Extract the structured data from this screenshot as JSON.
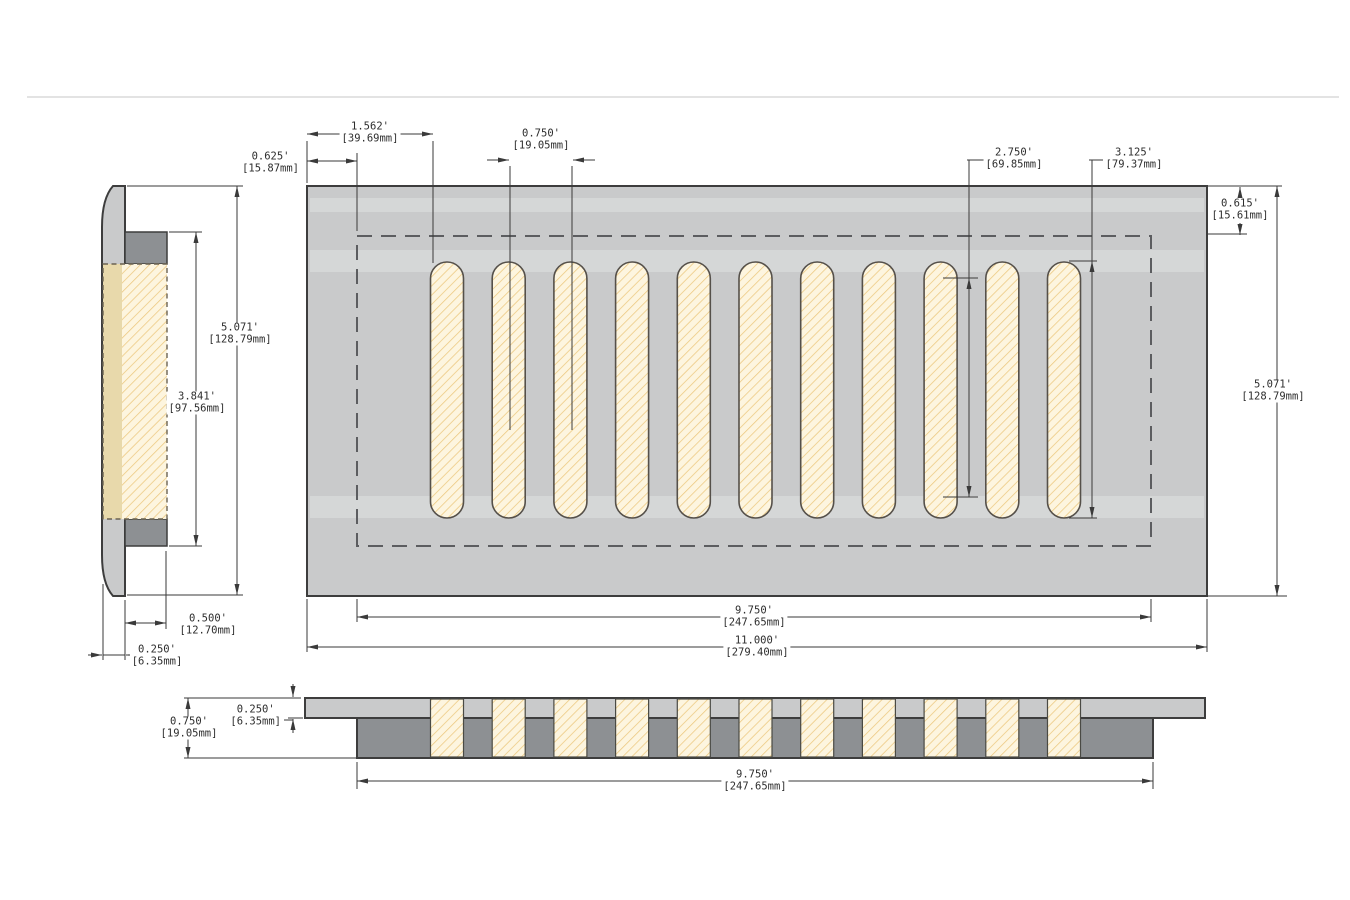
{
  "colors": {
    "plate": "#c9cacb",
    "collar": "#8d9093",
    "slot_fill": "#fdf5df",
    "hatch": "#ecc87e",
    "object_line": "#3d3d3d",
    "dim_line": "#3a3a3a",
    "dashed_line": "#5c5d60",
    "duct_strip": "#e8d9ab",
    "duct_dash": "#6b6352",
    "page_line": "#dadada",
    "text": "#2d2d2d"
  },
  "top_view": {
    "slot_count": 11,
    "dims": {
      "left_offset": {
        "in": "0.625'",
        "mm": "[15.87mm]"
      },
      "first_slot": {
        "in": "1.562'",
        "mm": "[39.69mm]"
      },
      "slot_pitch": {
        "in": "0.750'",
        "mm": "[19.05mm]"
      },
      "slot_inner_length": {
        "in": "2.750'",
        "mm": "[69.85mm]"
      },
      "slot_length": {
        "in": "3.125'",
        "mm": "[79.37mm]"
      },
      "top_offset": {
        "in": "0.615'",
        "mm": "[15.61mm]"
      },
      "height": {
        "in": "5.071'",
        "mm": "[128.79mm]"
      },
      "opening_width": {
        "in": "9.750'",
        "mm": "[247.65mm]"
      },
      "overall_width": {
        "in": "11.000'",
        "mm": "[279.40mm]"
      }
    }
  },
  "side_view": {
    "dims": {
      "height": {
        "in": "5.071'",
        "mm": "[128.79mm]"
      },
      "opening_height": {
        "in": "3.841'",
        "mm": "[97.56mm]"
      },
      "collar_depth": {
        "in": "0.500'",
        "mm": "[12.70mm]"
      },
      "face_thickness": {
        "in": "0.250'",
        "mm": "[6.35mm]"
      }
    }
  },
  "section_view": {
    "dims": {
      "overall_thickness": {
        "in": "0.750'",
        "mm": "[19.05mm]"
      },
      "face_thickness": {
        "in": "0.250'",
        "mm": "[6.35mm]"
      },
      "opening_width": {
        "in": "9.750'",
        "mm": "[247.65mm]"
      }
    }
  }
}
